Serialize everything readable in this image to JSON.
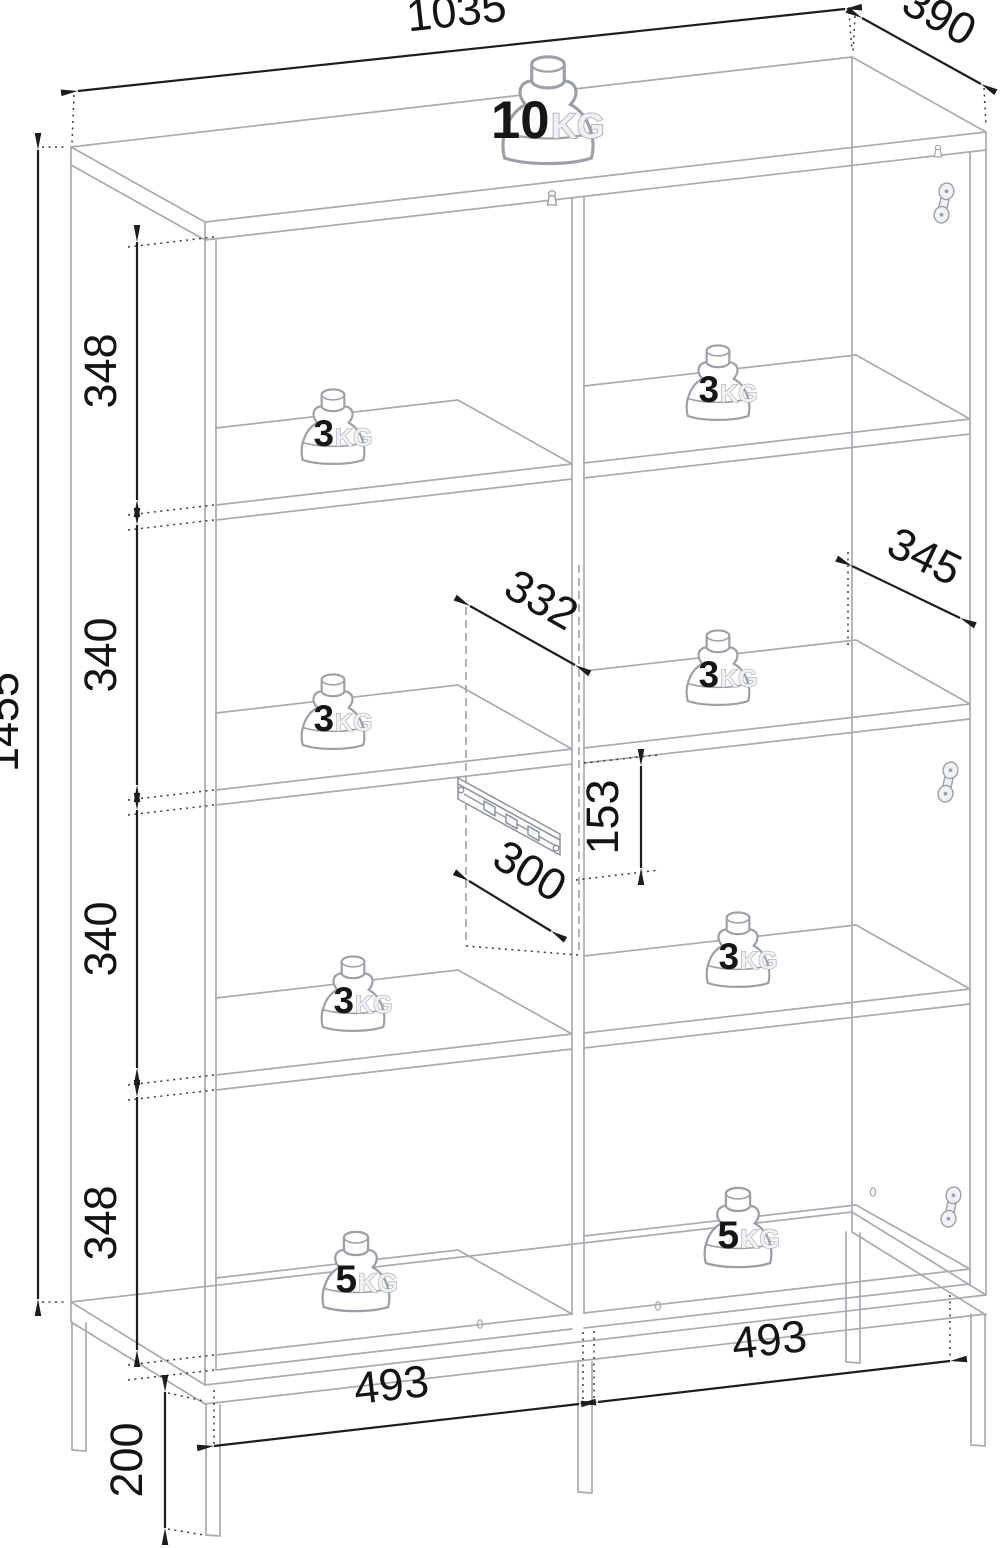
{
  "dims": {
    "top_width": "1035",
    "top_depth": "390",
    "overall_height": "1455",
    "sections": {
      "s1": "348",
      "s2": "340",
      "s3": "340",
      "s4": "348"
    },
    "shelf_depth_left": "332",
    "shelf_depth_right": "345",
    "drawer_height": "153",
    "drawer_depth": "300",
    "inner_width_left": "493",
    "inner_width_right": "493",
    "leg_height": "200"
  },
  "load_limits": {
    "top": {
      "value": "10",
      "unit": "KG"
    },
    "shelf": {
      "value": "3",
      "unit": "KG"
    },
    "bottom": {
      "value": "5",
      "unit": "KG"
    }
  },
  "icons": {
    "weight": "scale-weight",
    "hinge": "hinge-plate",
    "drawer_slide": "drawer-slide-rail",
    "lock": "cam-lock-fitting"
  },
  "colors": {
    "furniture_line": "#a7acb2",
    "dimension_line": "#1d1d1d",
    "background": "#ffffff"
  }
}
